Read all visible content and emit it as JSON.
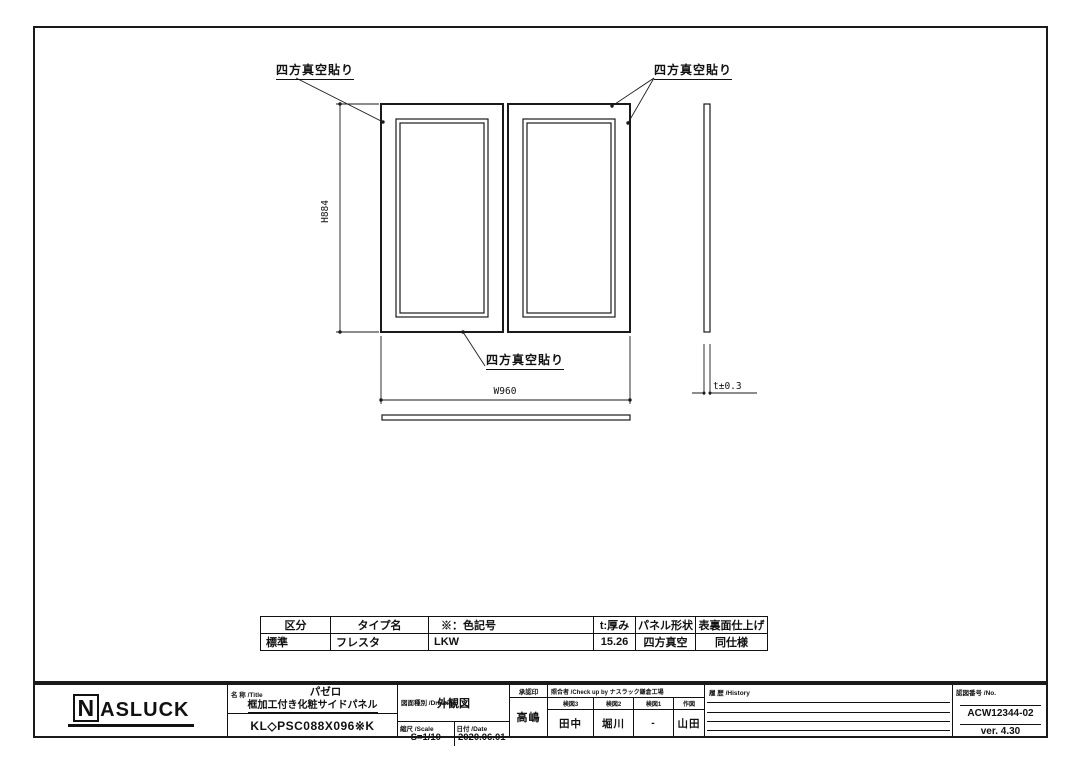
{
  "drawing": {
    "callout_top_left": "四方真空貼り",
    "callout_top_right": "四方真空貼り",
    "callout_bottom": "四方真空貼り",
    "dim_height": "H884",
    "dim_width": "W960",
    "dim_thickness": "t±0.3"
  },
  "spec_table": {
    "headers": [
      "区分",
      "タイプ名",
      "※：色記号",
      "t:厚み",
      "パネル形状",
      "表裏面仕上げ"
    ],
    "row": [
      "標準",
      "フレスタ",
      "LKW",
      "15.26",
      "四方真空",
      "同仕様"
    ]
  },
  "title_block": {
    "logo_n": "N",
    "logo_rest": "ASLUCK",
    "title_label": "名 称 /Title",
    "series": "パゼロ",
    "product_name": "框加工付き化粧サイドパネル",
    "product_code": "KL◇PSC088X096※K",
    "drawing_type_label": "図面種別 /Drawing",
    "drawing_type": "外観図",
    "scale_label": "縮尺 /Scale",
    "scale_value": "S=1/10",
    "date_label": "日付 /Date",
    "date_value": "2020.06.01",
    "approval_label": "承認印",
    "approval_name": "高嶋",
    "checkers_label": "照合者 /Check up by ナスラック鎌倉工場",
    "checker_headers": [
      "検図3",
      "検図2",
      "検図1",
      "作図"
    ],
    "checker_names": [
      "田中",
      "堀川",
      "-",
      "山田"
    ],
    "history_label": "履 歴 /History",
    "number_label": "認図番号 /No.",
    "drawing_number": "ACW12344-02",
    "version": "ver. 4.30"
  }
}
